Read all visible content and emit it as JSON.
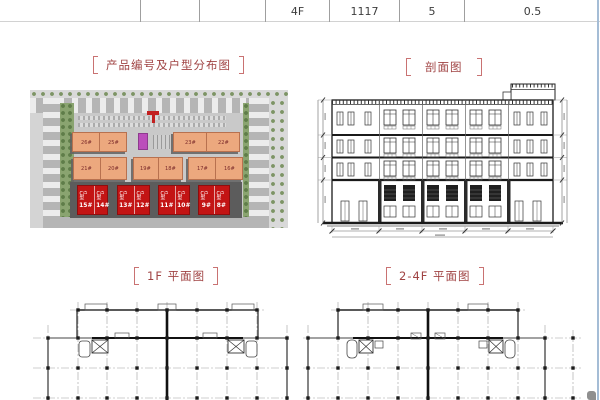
{
  "table": {
    "cells": [
      "",
      "",
      "",
      "4F",
      "1117",
      "5",
      "0.5"
    ]
  },
  "titles": {
    "siteplan": "产品编号及户型分布图",
    "section": "剖面图",
    "plan1f": "1F 平面图",
    "plan24f": "2-4F 平面图"
  },
  "siteplan": {
    "row1": [
      "26#",
      "25#",
      "23#",
      "22#"
    ],
    "row2": [
      "21#",
      "20#",
      "19#",
      "18#",
      "17#",
      "16#"
    ],
    "row3": [
      {
        "type": "C户型",
        "num": "15#"
      },
      {
        "type": "C户型",
        "num": "14#"
      },
      {
        "type": "C户型",
        "num": "13#"
      },
      {
        "type": "C户型",
        "num": "12#"
      },
      {
        "type": "C户型",
        "num": "11#"
      },
      {
        "type": "C户型",
        "num": "10#"
      },
      {
        "type": "C户型",
        "num": "9#"
      },
      {
        "type": "C户型",
        "num": "8#"
      }
    ]
  },
  "colors": {
    "title_red": "#a04343",
    "bracket_red": "#c97272",
    "building_orange": "#eca87e",
    "building_red": "#c31414",
    "building_magenta": "#bb4ebb",
    "right_edge_blue": "#a5bdd6"
  }
}
